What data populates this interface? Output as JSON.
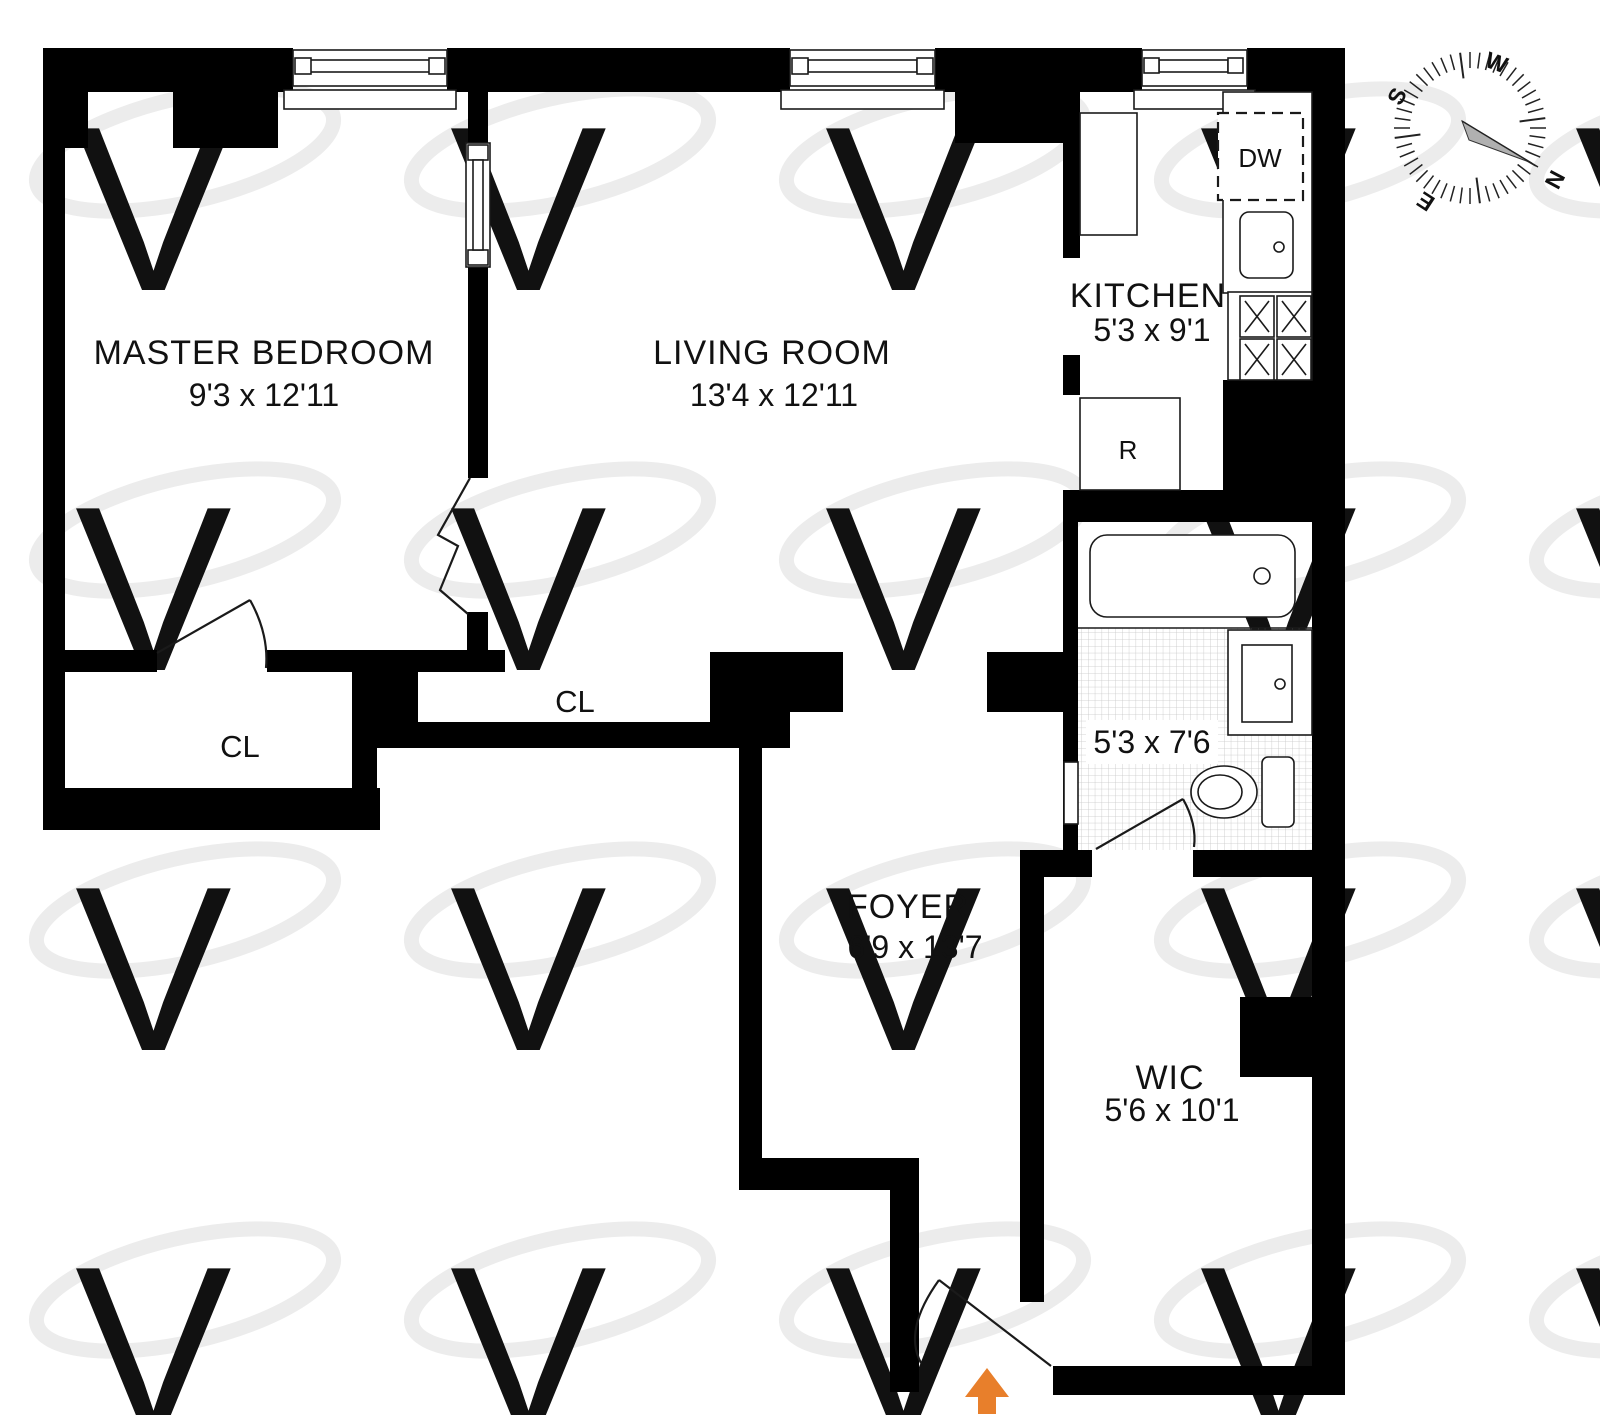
{
  "title": "Apartment floor plan",
  "watermark": {
    "letter": "V"
  },
  "rooms": {
    "master_bedroom": {
      "name": "MASTER BEDROOM",
      "dims": "9'3 x 12'11"
    },
    "living_room": {
      "name": "LIVING ROOM",
      "dims": "13'4 x 12'11"
    },
    "kitchen": {
      "name": "KITCHEN",
      "dims": "5'3 x 9'1"
    },
    "foyer": {
      "name": "FOYER",
      "dims": "6'9 x 13'7"
    },
    "bathroom": {
      "dims": "5'3 x 7'6"
    },
    "wic": {
      "name": "WIC",
      "dims": "5'6 x 10'1"
    },
    "closet_master": {
      "label": "CL"
    },
    "closet_hall": {
      "label": "CL"
    }
  },
  "appliances": {
    "dishwasher": "DW",
    "refrigerator": "R"
  },
  "compass": {
    "n": "N",
    "e": "E",
    "s": "S",
    "w": "W",
    "cx": 1470,
    "cy": 128,
    "tick_count": 48,
    "tick_inner": 60,
    "tick_outer": 76,
    "long_every": 12,
    "long_inner": 50
  },
  "entry": {
    "arrow_color": "#e87f2b"
  },
  "palette": {
    "walls": "#000000",
    "watermark_gray": "#e9e9e9",
    "tile_gray": "#c6c6c6",
    "entry_arrow": "#e87f2b"
  }
}
